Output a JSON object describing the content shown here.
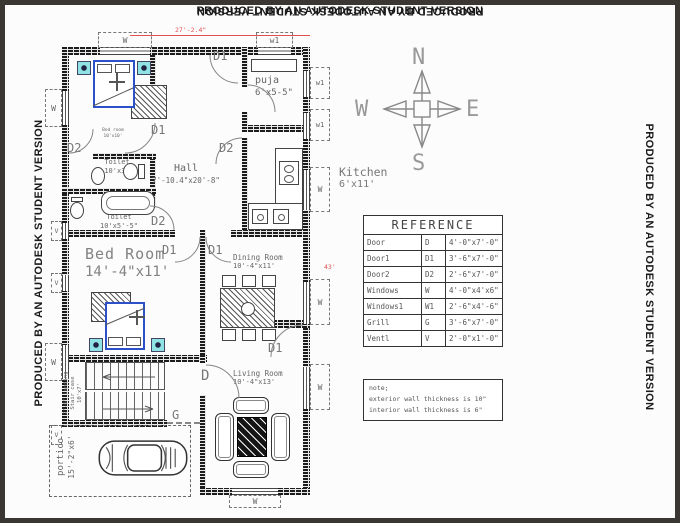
{
  "banners": {
    "top": "PRODUCED BY AN AUTODESK STUDENT VERSION",
    "right": "PRODUCED BY AN AUTODESK STUDENT VERSION",
    "bottom": "PRODUCED BY AN AUTODESK STUDENT VERSION",
    "left": "PRODUCED BY AN AUTODESK STUDENT VERSION"
  },
  "compass": {
    "north": "N",
    "south": "S",
    "east": "E",
    "west": "W"
  },
  "dimensions": {
    "top_width": "27'-2.4\"",
    "right_height": "43'"
  },
  "tags": {
    "d": "D",
    "d1": "D1",
    "d2": "D2",
    "w": "W",
    "w1": "w1",
    "v": "V",
    "g": "G"
  },
  "rooms": {
    "bedroom_top": {
      "name": "Bed room",
      "size": "10'x10'"
    },
    "puja": {
      "name": "puja",
      "size": "6'x5-5\""
    },
    "hall": {
      "name": "Hall",
      "size": "7'-10.4\"x20'-8\""
    },
    "kitchen": {
      "name": "Kitchen",
      "size": "6'x11'"
    },
    "toilet1": {
      "name": "Toilet",
      "size": "10'x3'"
    },
    "toilet2": {
      "name": "Toilet",
      "size": "10'x5'-5\""
    },
    "bedroom_mid": {
      "name": "Bed Room",
      "size": "14'-4\"x11'"
    },
    "dining": {
      "name": "Dining Room",
      "size": "10'-4\"x11'"
    },
    "living": {
      "name": "Living Room",
      "size": "10'-4\"x13'"
    },
    "stair": {
      "landing": "2'-6\" Landing",
      "name": "Stair case",
      "size": "10'x7'"
    },
    "portico": {
      "name": "portico",
      "size": "15'-2\"x6'"
    }
  },
  "reference_table": {
    "title": "REFERENCE",
    "rows": [
      {
        "item": "Door",
        "code": "D",
        "size": "4'-0\"x7'-0\""
      },
      {
        "item": "Door1",
        "code": "D1",
        "size": "3'-6\"x7'-0\""
      },
      {
        "item": "Door2",
        "code": "D2",
        "size": "2'-6\"x7'-0\""
      },
      {
        "item": "Windows",
        "code": "W",
        "size": "4'-0\"x4'x6\""
      },
      {
        "item": "Windows1",
        "code": "W1",
        "size": "2'-6\"x4'-6\""
      },
      {
        "item": "Grill",
        "code": "G",
        "size": "3'-6\"x7'-0\""
      },
      {
        "item": "Ventl",
        "code": "V",
        "size": "2'-0\"x1'-0\""
      }
    ]
  },
  "note": {
    "line1": "note;",
    "line2": "exterior wall thickness is 10\"",
    "line3": "interior wall thickness is 6\""
  },
  "colors": {
    "wall": "#1c1c1c",
    "bed_outline": "#2b50c8",
    "side_table": "#8fe3e3",
    "dimension_red": "#e05050",
    "banner_text": "#1a1a1a"
  }
}
